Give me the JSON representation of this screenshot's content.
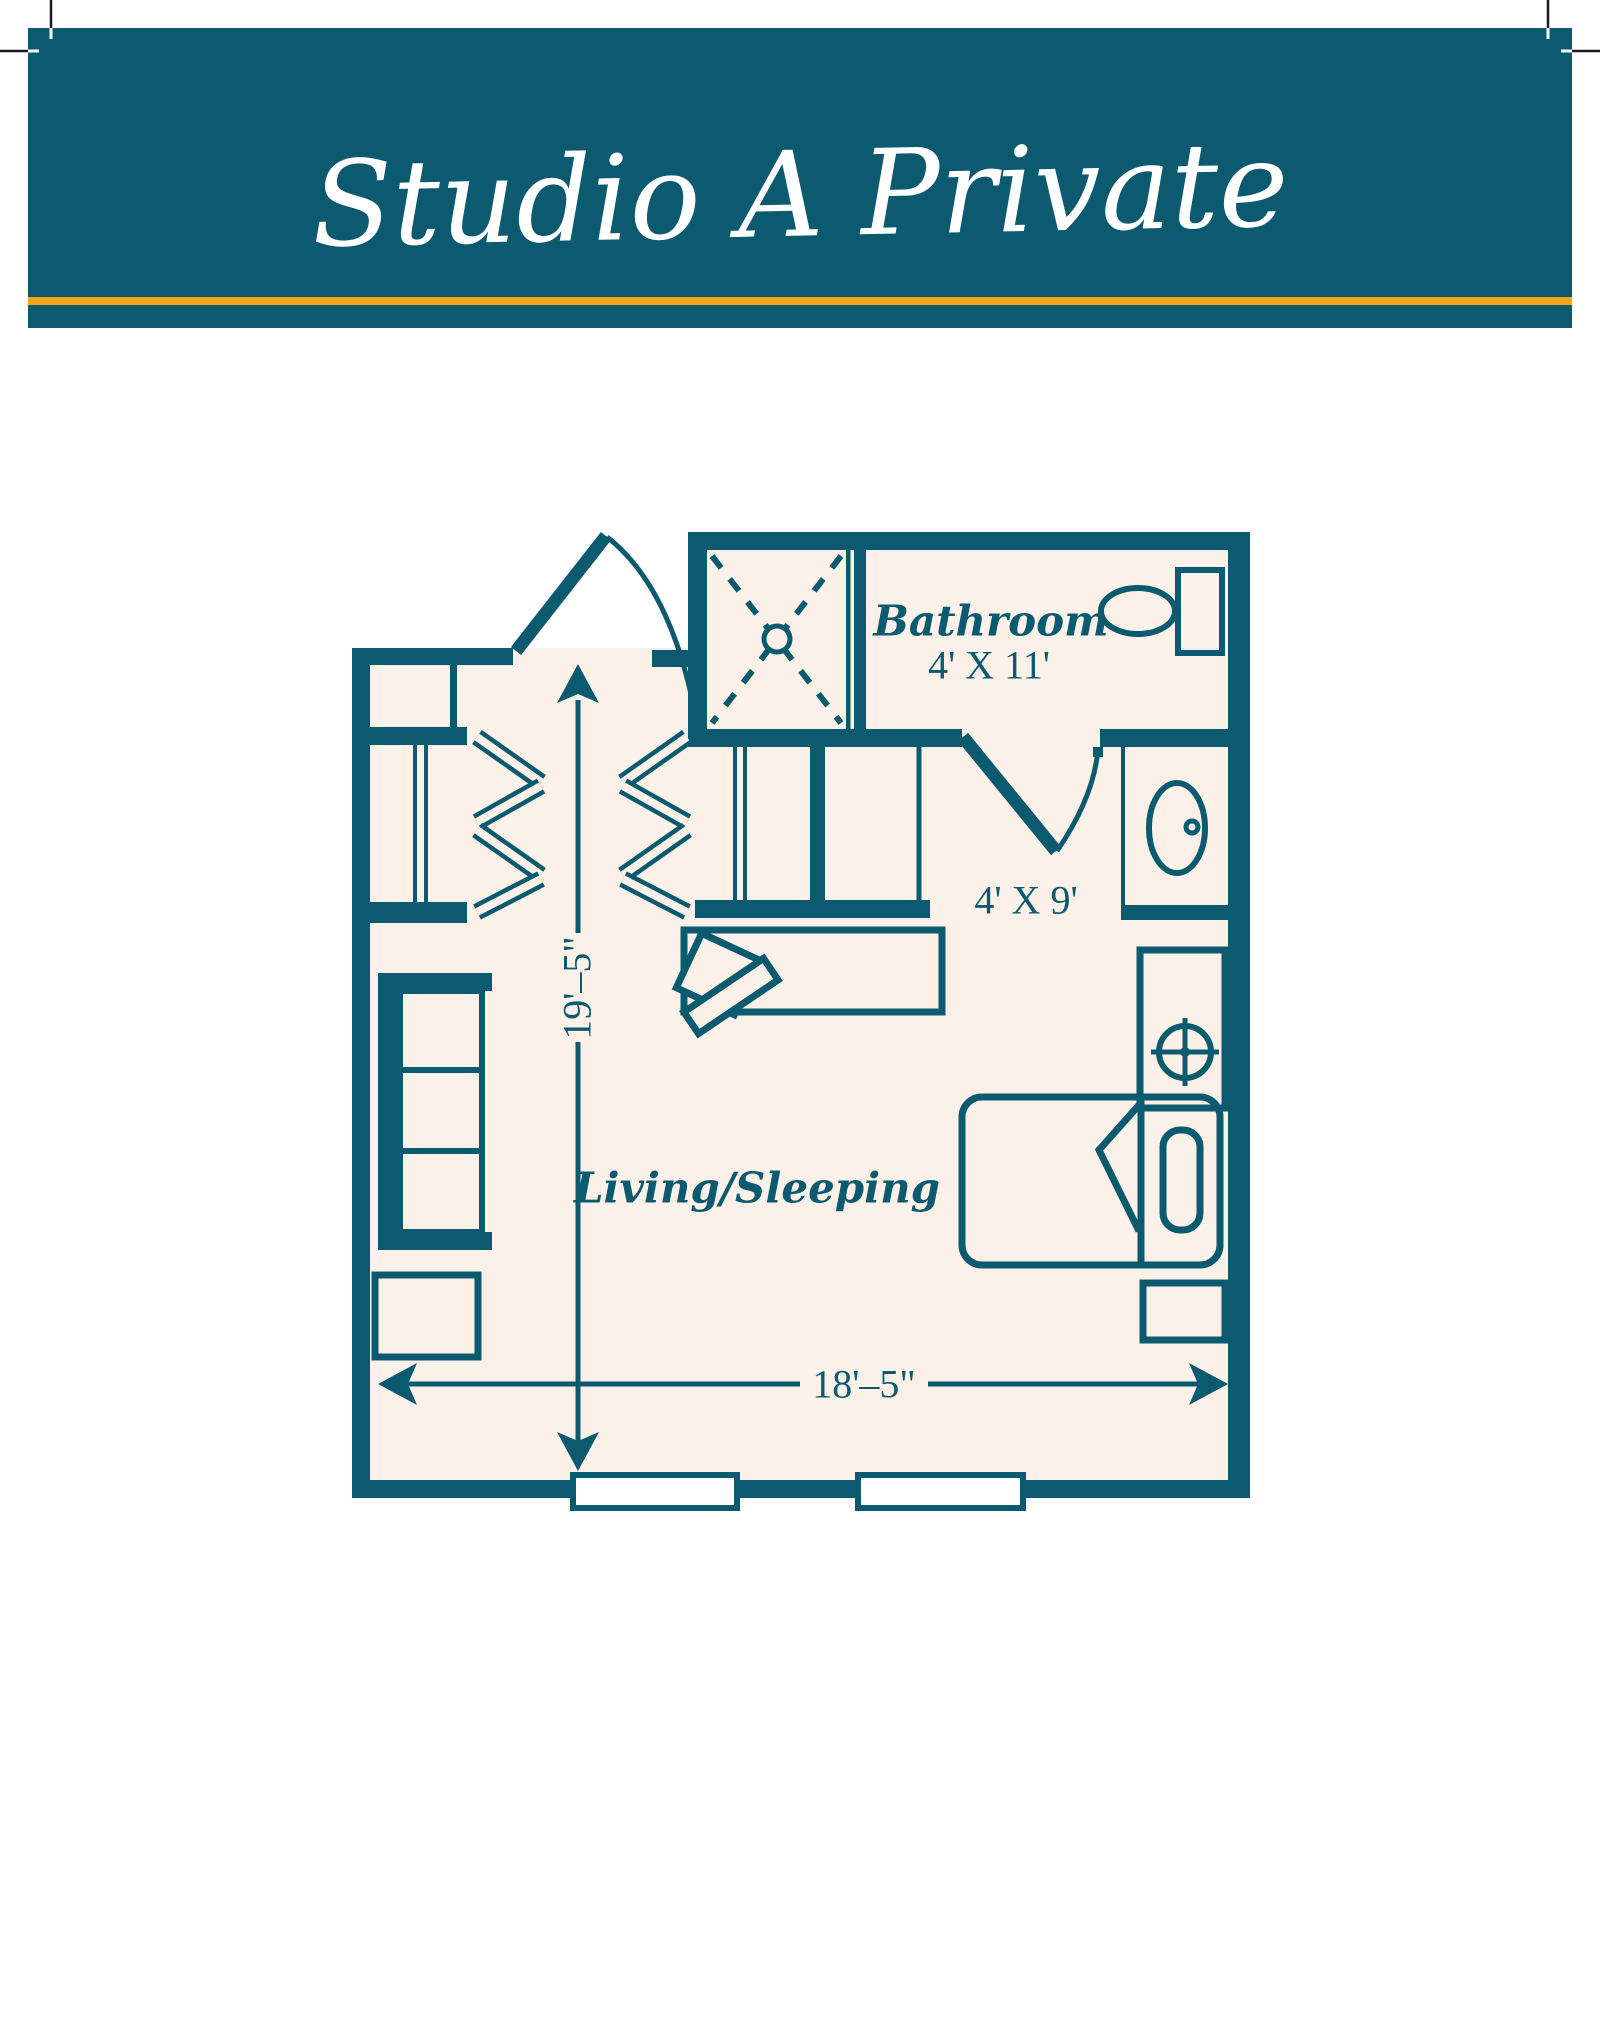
{
  "banner": {
    "title": "Studio A Private",
    "bg_color": "#0c5a70",
    "accent_line_color": "#f9a51a",
    "title_color": "#ffffff"
  },
  "plan": {
    "wall_color": "#0c5a70",
    "floor_color": "#fcf1e8",
    "labels": {
      "bathroom": "Bathroom",
      "bathroom_dim": "4' X 11'",
      "hall_dim": "4' X 9'",
      "living": "Living/Sleeping",
      "height_dim": "19'–5\"",
      "width_dim": "18'–5\""
    }
  }
}
